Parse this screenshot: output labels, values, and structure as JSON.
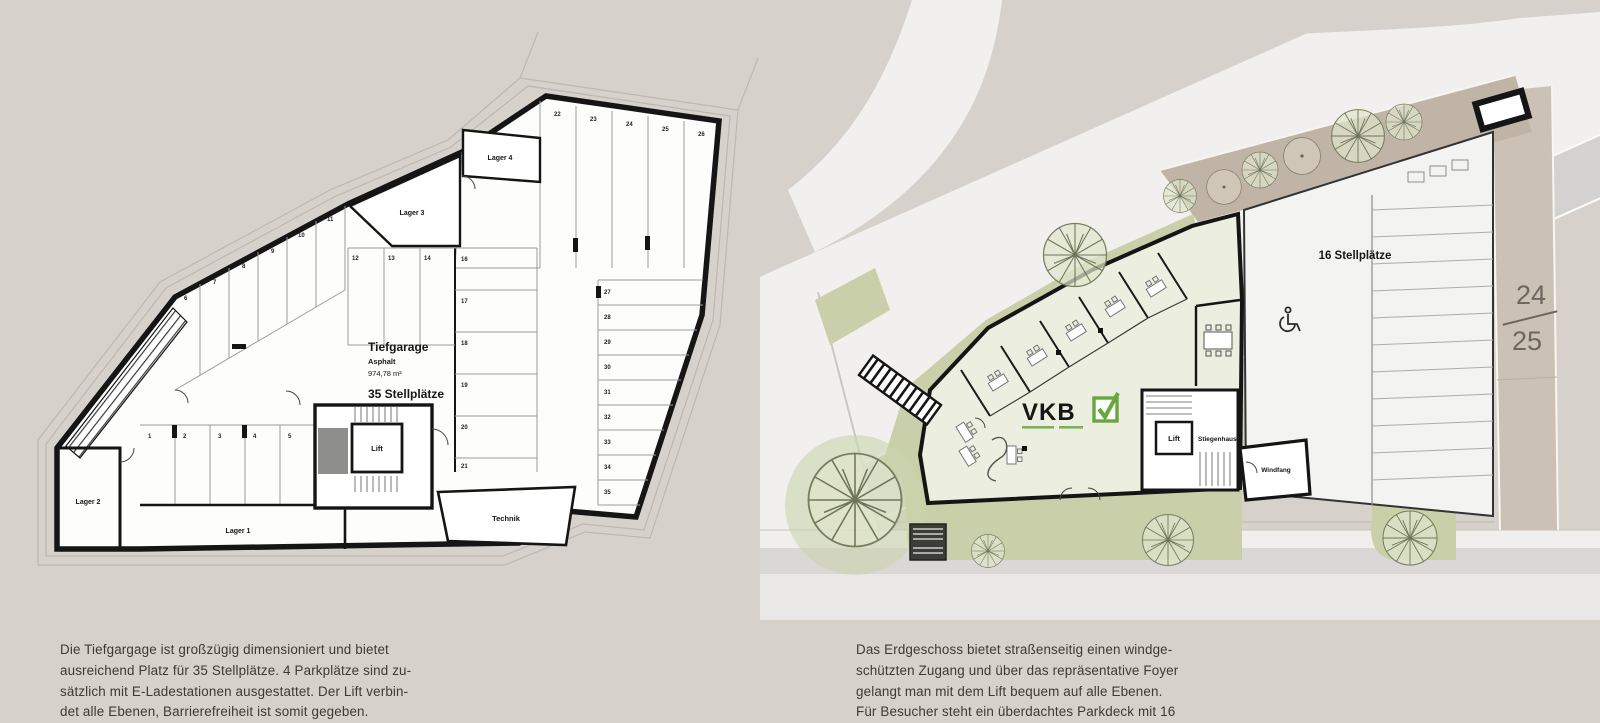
{
  "page": {
    "background": "#d6d2cb",
    "page_number": {
      "top": "24",
      "bottom": "25"
    }
  },
  "colors": {
    "wall_black": "#151515",
    "plan_white": "#fdfdfc",
    "road_white": "#f1f0ee",
    "sidewalk_gray": "#d3d2d0",
    "bottom_road_gray": "#dcdbd9",
    "green_landscape": "#c8cfa9",
    "building_interior": "#ecefe0",
    "terrace_taupe": "#c0b4a6",
    "vkb_green": "#67a73d",
    "caption_text": "#3e3933"
  },
  "tiefgarage": {
    "title": "Tiefgarage",
    "surface": "Asphalt",
    "area": "974,78 m²",
    "capacity": "35 Stellplätze",
    "rooms": {
      "lager1": "Lager 1",
      "lager2": "Lager 2",
      "lager3": "Lager 3",
      "lager4": "Lager 4",
      "lift": "Lift",
      "technik": "Technik"
    },
    "stall_numbers": {
      "bottom_row": [
        "1",
        "2",
        "3",
        "4",
        "5"
      ],
      "left_row": [
        "6",
        "7",
        "8",
        "9",
        "10",
        "11"
      ],
      "middle_row": [
        "12",
        "13",
        "14"
      ],
      "center_column": [
        "16",
        "17",
        "18",
        "19",
        "20",
        "21"
      ],
      "top_row": [
        "22",
        "23",
        "24",
        "25",
        "26"
      ],
      "right_column": [
        "27",
        "28",
        "29",
        "30",
        "31",
        "32",
        "33",
        "34",
        "35"
      ]
    },
    "caption": [
      "Die Tiefgargage ist großzügig dimensioniert und bietet",
      "ausreichend Platz für 35 Stellplätze. 4 Parkplätze sind zu-",
      "sätzlich mit E-Ladestationen ausgestattet. Der Lift verbin-",
      "det alle Ebenen, Barrierefreiheit ist somit gegeben."
    ]
  },
  "erdgeschoss": {
    "rooms": {
      "lift": "Lift",
      "stiegenhaus": "Stiegenhaus",
      "windfang": "Windfang"
    },
    "parkdeck_label": "16 Stellplätze",
    "logo": {
      "text": "VKB",
      "color": "#67a73d"
    },
    "caption": [
      "Das Erdgeschoss bietet straßenseitig einen windge-",
      "schützten Zugang und über das repräsentative Foyer",
      "gelangt man mit dem Lift bequem auf alle Ebenen.",
      "Für Besucher steht ein überdachtes Parkdeck mit 16"
    ]
  }
}
